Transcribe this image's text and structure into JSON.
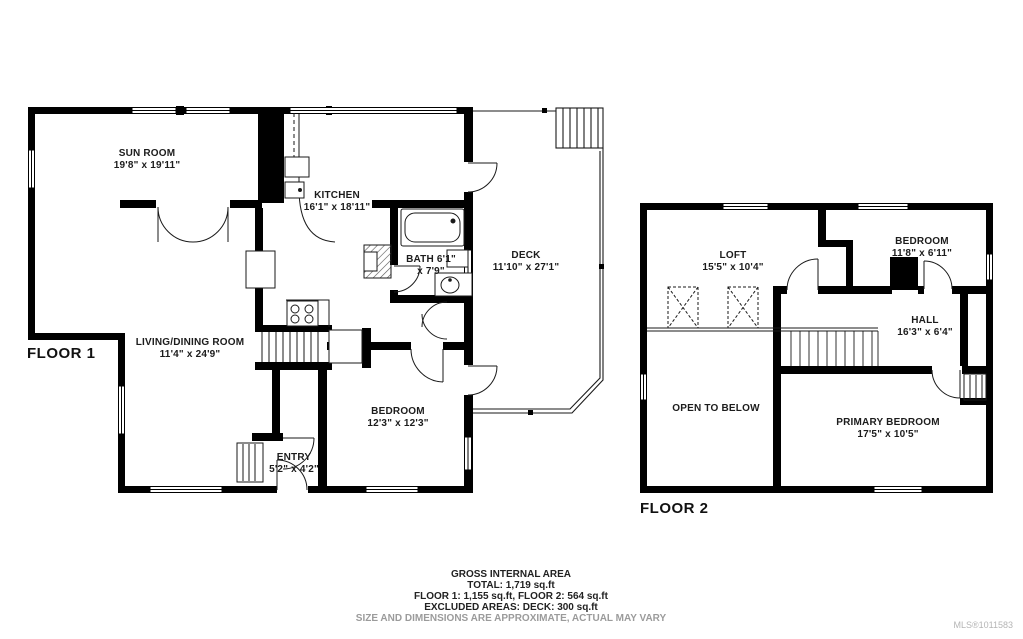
{
  "colors": {
    "wall": "#000000",
    "label": "#1c1c1c",
    "muted_text": "#9b9b9b",
    "watermark": "#b5b5b5"
  },
  "floor1": {
    "label": "FLOOR 1",
    "rooms": [
      {
        "name": "SUN ROOM",
        "dims": "19'8\" x 19'11\""
      },
      {
        "name": "KITCHEN",
        "dims": "16'1\" x 18'11\""
      },
      {
        "name": "BATH",
        "dims": "6'1\" x 7'9\""
      },
      {
        "name": "DECK",
        "dims": "11'10\" x 27'1\""
      },
      {
        "name": "LIVING/DINING ROOM",
        "dims": "11'4\" x 24'9\""
      },
      {
        "name": "BEDROOM",
        "dims": "12'3\" x 12'3\""
      },
      {
        "name": "ENTRY",
        "dims": "5'2\" x 4'2\""
      }
    ]
  },
  "floor2": {
    "label": "FLOOR 2",
    "rooms": [
      {
        "name": "LOFT",
        "dims": "15'5\" x 10'4\""
      },
      {
        "name": "BEDROOM",
        "dims": "11'8\" x 6'11\""
      },
      {
        "name": "HALL",
        "dims": "16'3\" x 6'4\""
      },
      {
        "name": "OPEN TO BELOW",
        "dims": ""
      },
      {
        "name": "PRIMARY BEDROOM",
        "dims": "17'5\" x 10'5\""
      }
    ]
  },
  "footer": {
    "line1": "GROSS INTERNAL AREA",
    "line2": "TOTAL: 1,719 sq.ft",
    "line3": "FLOOR 1: 1,155 sq.ft, FLOOR 2: 564 sq.ft",
    "line4": "EXCLUDED AREAS: DECK: 300 sq.ft",
    "line5": "SIZE AND DIMENSIONS ARE APPROXIMATE, ACTUAL MAY VARY"
  },
  "watermark": "MLS®1011583"
}
